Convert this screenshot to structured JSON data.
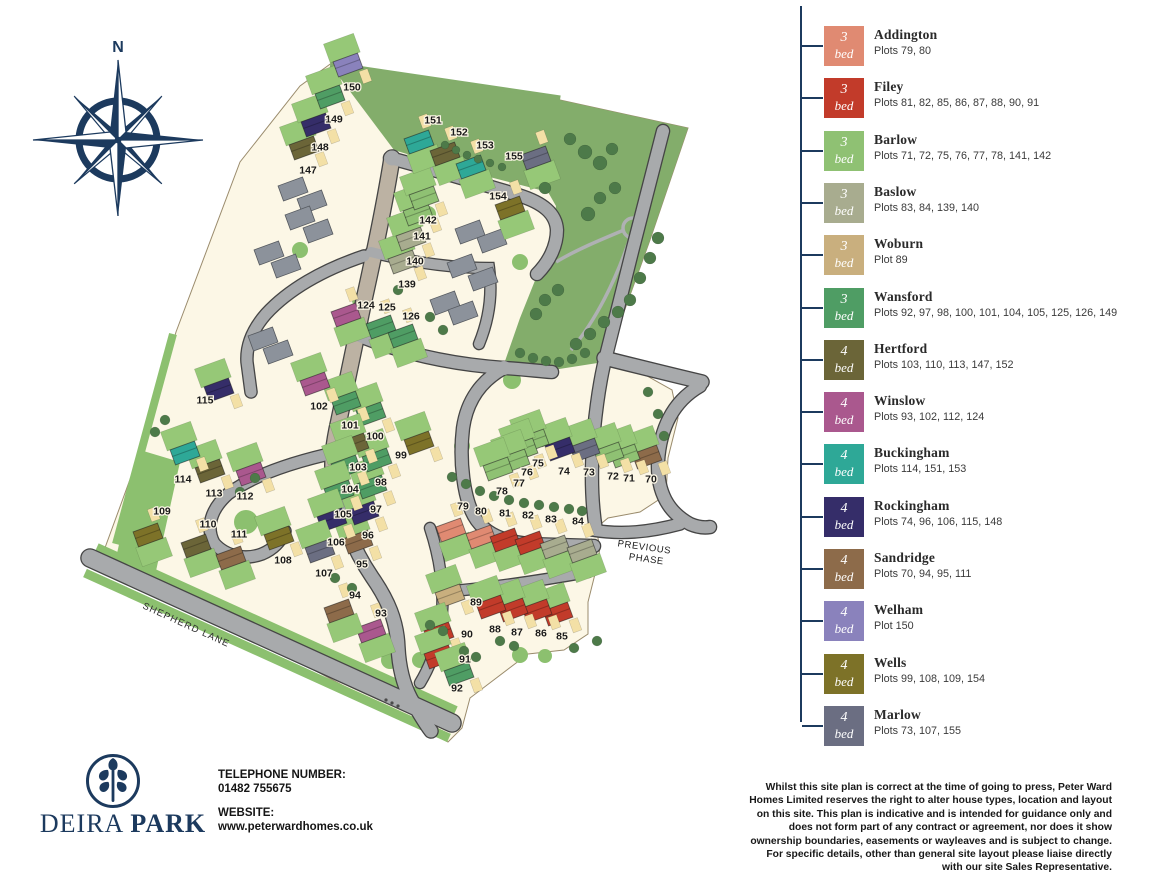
{
  "compass": {
    "north_label": "N"
  },
  "colors": {
    "navy": "#1C3A5E",
    "cream": "#FCF7E6",
    "road": "#A8AAAC",
    "road_tan": "#BCB2A3",
    "green_bright": "#8CC06F",
    "green_dark_area": "#83AD6B",
    "tree": "#4D7A49",
    "garden": "#96C877",
    "drive": "#F3E0A6",
    "grey_building": "#8C929B"
  },
  "legend": {
    "items": [
      {
        "key": "addington",
        "name": "Addington",
        "bed": "3",
        "bed_word": "bed",
        "plots": "Plots 79, 80",
        "color": "#E08A72"
      },
      {
        "key": "filey",
        "name": "Filey",
        "bed": "3",
        "bed_word": "bed",
        "plots": "Plots 81, 82, 85, 86, 87, 88, 90, 91",
        "color": "#C23B2A"
      },
      {
        "key": "barlow",
        "name": "Barlow",
        "bed": "3",
        "bed_word": "bed",
        "plots": "Plots 71, 72, 75, 76, 77, 78, 141, 142",
        "color": "#8FC173"
      },
      {
        "key": "baslow",
        "name": "Baslow",
        "bed": "3",
        "bed_word": "bed",
        "plots": "Plots 83, 84, 139, 140",
        "color": "#A8AC8F"
      },
      {
        "key": "woburn",
        "name": "Woburn",
        "bed": "3",
        "bed_word": "bed",
        "plots": "Plot 89",
        "color": "#C9AF7E"
      },
      {
        "key": "wansford",
        "name": "Wansford",
        "bed": "3",
        "bed_word": "bed",
        "plots": "Plots 92, 97, 98, 100, 101, 104, 105, 125, 126, 149",
        "color": "#4F9D64"
      },
      {
        "key": "hertford",
        "name": "Hertford",
        "bed": "4",
        "bed_word": "bed",
        "plots": "Plots 103, 110, 113, 147, 152",
        "color": "#6B6538"
      },
      {
        "key": "winslow",
        "name": "Winslow",
        "bed": "4",
        "bed_word": "bed",
        "plots": "Plots 93, 102, 112, 124",
        "color": "#AA588E"
      },
      {
        "key": "buckingham",
        "name": "Buckingham",
        "bed": "4",
        "bed_word": "bed",
        "plots": "Plots 114, 151, 153",
        "color": "#2EA897"
      },
      {
        "key": "rockingham",
        "name": "Rockingham",
        "bed": "4",
        "bed_word": "bed",
        "plots": "Plots 74, 96, 106, 115, 148",
        "color": "#352D69"
      },
      {
        "key": "sandridge",
        "name": "Sandridge",
        "bed": "4",
        "bed_word": "bed",
        "plots": "Plots 70, 94, 95, 111",
        "color": "#8D6B4A"
      },
      {
        "key": "welham",
        "name": "Welham",
        "bed": "4",
        "bed_word": "bed",
        "plots": "Plot 150",
        "color": "#8A82BC"
      },
      {
        "key": "wells",
        "name": "Wells",
        "bed": "4",
        "bed_word": "bed",
        "plots": "Plots 99, 108, 109, 154",
        "color": "#7D7228"
      },
      {
        "key": "marlow",
        "name": "Marlow",
        "bed": "4",
        "bed_word": "bed",
        "plots": "Plots 73, 107, 155",
        "color": "#6B6E82"
      }
    ]
  },
  "map": {
    "labels": {
      "previous_phase_1": "PREVIOUS",
      "previous_phase_2": "PHASE",
      "shepherd_lane": "SHEPHERD LANE"
    },
    "plots": [
      {
        "n": "70",
        "x": 651,
        "y": 479,
        "t": "sandridge"
      },
      {
        "n": "71",
        "x": 629,
        "y": 478,
        "t": "barlow"
      },
      {
        "n": "72",
        "x": 613,
        "y": 476,
        "t": "barlow"
      },
      {
        "n": "73",
        "x": 589,
        "y": 472,
        "t": "marlow"
      },
      {
        "n": "74",
        "x": 564,
        "y": 471,
        "t": "rockingham"
      },
      {
        "n": "75",
        "x": 538,
        "y": 463,
        "t": "barlow"
      },
      {
        "n": "76",
        "x": 527,
        "y": 472,
        "t": "barlow"
      },
      {
        "n": "77",
        "x": 519,
        "y": 483,
        "t": "barlow"
      },
      {
        "n": "78",
        "x": 502,
        "y": 491,
        "t": "barlow"
      },
      {
        "n": "79",
        "x": 463,
        "y": 506,
        "t": "addington",
        "dx": -12,
        "dy": 24
      },
      {
        "n": "80",
        "x": 481,
        "y": 511,
        "t": "addington",
        "dx": 0,
        "dy": 26
      },
      {
        "n": "81",
        "x": 505,
        "y": 513,
        "t": "filey",
        "dx": 0,
        "dy": 27
      },
      {
        "n": "82",
        "x": 528,
        "y": 515,
        "t": "filey",
        "dx": 2,
        "dy": 28
      },
      {
        "n": "83",
        "x": 551,
        "y": 519,
        "t": "baslow",
        "dx": 4,
        "dy": 28
      },
      {
        "n": "84",
        "x": 578,
        "y": 521,
        "t": "baslow",
        "dx": 4,
        "dy": 30
      },
      {
        "n": "85",
        "x": 562,
        "y": 636,
        "t": "filey"
      },
      {
        "n": "86",
        "x": 541,
        "y": 633,
        "t": "filey"
      },
      {
        "n": "87",
        "x": 517,
        "y": 632,
        "t": "filey"
      },
      {
        "n": "88",
        "x": 495,
        "y": 629,
        "t": "filey"
      },
      {
        "n": "89",
        "x": 476,
        "y": 602,
        "t": "woburn",
        "dx": -26,
        "dy": -6
      },
      {
        "n": "90",
        "x": 467,
        "y": 634,
        "t": "filey",
        "dx": -28,
        "dy": 0
      },
      {
        "n": "91",
        "x": 465,
        "y": 659,
        "t": "filey",
        "dx": -26,
        "dy": -2
      },
      {
        "n": "92",
        "x": 457,
        "y": 688,
        "t": "wansford",
        "dx": 2,
        "dy": -14
      },
      {
        "n": "93",
        "x": 381,
        "y": 613,
        "t": "winslow",
        "dx": -10,
        "dy": 18
      },
      {
        "n": "94",
        "x": 355,
        "y": 595,
        "t": "sandridge",
        "dx": -16,
        "dy": 16
      },
      {
        "n": "95",
        "x": 362,
        "y": 564,
        "t": "sandridge"
      },
      {
        "n": "96",
        "x": 368,
        "y": 535,
        "t": "rockingham"
      },
      {
        "n": "97",
        "x": 376,
        "y": 509,
        "t": "wansford"
      },
      {
        "n": "98",
        "x": 381,
        "y": 482,
        "t": "wansford"
      },
      {
        "n": "99",
        "x": 401,
        "y": 455,
        "t": "wells",
        "dx": 18,
        "dy": -12
      },
      {
        "n": "100",
        "x": 375,
        "y": 436,
        "t": "wansford"
      },
      {
        "n": "101",
        "x": 350,
        "y": 425,
        "t": "wansford"
      },
      {
        "n": "102",
        "x": 319,
        "y": 406,
        "t": "winslow"
      },
      {
        "n": "103",
        "x": 358,
        "y": 467,
        "t": "hertford"
      },
      {
        "n": "104",
        "x": 350,
        "y": 489,
        "t": "wansford"
      },
      {
        "n": "105",
        "x": 343,
        "y": 514,
        "t": "wansford"
      },
      {
        "n": "106",
        "x": 336,
        "y": 542,
        "t": "rockingham"
      },
      {
        "n": "107",
        "x": 324,
        "y": 573,
        "t": "marlow"
      },
      {
        "n": "108",
        "x": 283,
        "y": 560,
        "t": "wells"
      },
      {
        "n": "109",
        "x": 162,
        "y": 511,
        "t": "wells",
        "dx": -14,
        "dy": 24
      },
      {
        "n": "110",
        "x": 208,
        "y": 524,
        "t": "hertford",
        "dx": -12,
        "dy": 22
      },
      {
        "n": "111",
        "x": 239,
        "y": 534,
        "t": "sandridge",
        "dx": -8,
        "dy": 24
      },
      {
        "n": "112",
        "x": 245,
        "y": 496,
        "t": "winslow",
        "dx": 6,
        "dy": -22
      },
      {
        "n": "113",
        "x": 214,
        "y": 493,
        "t": "hertford"
      },
      {
        "n": "114",
        "x": 183,
        "y": 479,
        "t": "buckingham",
        "dx": 2,
        "dy": -26
      },
      {
        "n": "115",
        "x": 205,
        "y": 400,
        "t": "rockingham",
        "dx": 14,
        "dy": -10
      },
      {
        "n": "124",
        "x": 366,
        "y": 305,
        "t": "winslow",
        "dx": -20,
        "dy": 10
      },
      {
        "n": "125",
        "x": 387,
        "y": 307,
        "t": "wansford",
        "dx": -6,
        "dy": 20
      },
      {
        "n": "126",
        "x": 411,
        "y": 316,
        "t": "wansford",
        "dx": -8,
        "dy": 20
      },
      {
        "n": "139",
        "x": 407,
        "y": 284,
        "t": "baslow"
      },
      {
        "n": "140",
        "x": 415,
        "y": 261,
        "t": "baslow"
      },
      {
        "n": "141",
        "x": 422,
        "y": 236,
        "t": "barlow"
      },
      {
        "n": "142",
        "x": 428,
        "y": 220,
        "t": "barlow"
      },
      {
        "n": "147",
        "x": 308,
        "y": 170,
        "t": "hertford"
      },
      {
        "n": "148",
        "x": 320,
        "y": 147,
        "t": "rockingham"
      },
      {
        "n": "149",
        "x": 334,
        "y": 119,
        "t": "wansford"
      },
      {
        "n": "150",
        "x": 352,
        "y": 87,
        "t": "welham"
      },
      {
        "n": "151",
        "x": 433,
        "y": 120,
        "t": "buckingham",
        "dx": -14,
        "dy": 22
      },
      {
        "n": "152",
        "x": 459,
        "y": 132,
        "t": "hertford",
        "dx": -14,
        "dy": 22
      },
      {
        "n": "153",
        "x": 485,
        "y": 145,
        "t": "buckingham",
        "dx": -14,
        "dy": 22
      },
      {
        "n": "154",
        "x": 498,
        "y": 196,
        "t": "wells",
        "dx": 12,
        "dy": 12
      },
      {
        "n": "155",
        "x": 514,
        "y": 156,
        "t": "marlow",
        "dx": 22,
        "dy": 2
      }
    ]
  },
  "footer": {
    "logo_word_1": "DEIRA",
    "logo_word_2": "PARK",
    "phone_label": "TELEPHONE NUMBER:",
    "phone": "01482 755675",
    "website_label": "WEBSITE:",
    "website": "www.peterwardhomes.co.uk",
    "disclaimer": "Whilst this site plan is correct at the time of going to press, Peter Ward Homes Limited reserves the right to alter house types, location and layout on this site. This plan is indicative and is intended for guidance only and does not form part of any contract or agreement, nor does it show ownership boundaries, easements or wayleaves and is subject to change. For specific details, other than general site layout please liaise directly with our site Sales Representative."
  }
}
